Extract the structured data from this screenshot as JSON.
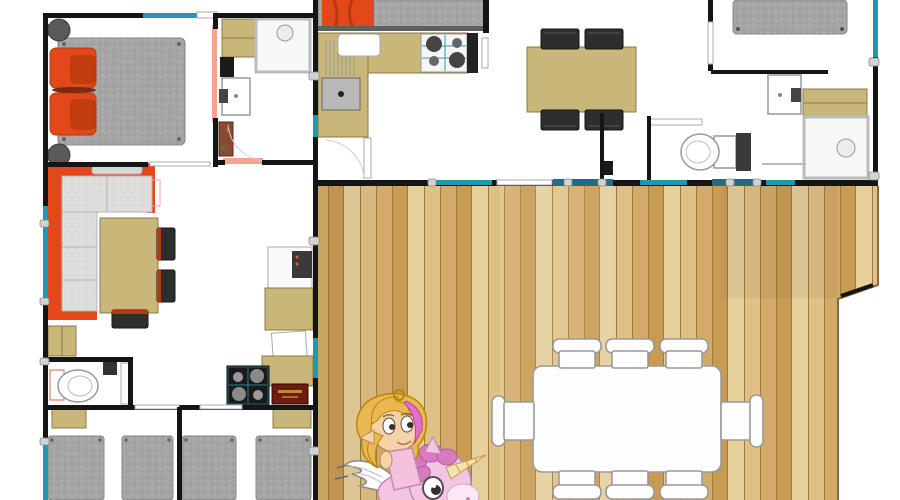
{
  "meta": {
    "type": "architectural floor plan",
    "subject": "two holiday-home units joined by a large wooden deck terrace",
    "visible_text": "none (plaque lettering illegible at source resolution)"
  },
  "left_unit": {
    "label": "left accommodation unit",
    "rooms": [
      {
        "name": "double bedroom",
        "items": [
          "double bed",
          "orange pillows",
          "round bedside stool",
          "round bedside stool",
          "salmon sliding door"
        ]
      },
      {
        "name": "shower room",
        "items": [
          "wardrobe",
          "black appliance",
          "shower cabin",
          "washbasin",
          "water heater"
        ]
      },
      {
        "name": "living room",
        "items": [
          "orange corner sofa",
          "dining table",
          "side chair",
          "side chair",
          "end chair",
          "low cabinet",
          "radiator"
        ]
      },
      {
        "name": "kitchenette",
        "items": [
          "fridge",
          "microwave",
          "worktop",
          "gas hob",
          "dark red plaque",
          "door"
        ]
      },
      {
        "name": "wc",
        "items": [
          "toilet",
          "wall cabinet",
          "door"
        ]
      },
      {
        "name": "twin bedroom left",
        "items": [
          "single bed",
          "single bed",
          "headboard shelf"
        ]
      },
      {
        "name": "twin bedroom right",
        "items": [
          "single bed",
          "single bed",
          "headboard shelf"
        ]
      }
    ]
  },
  "right_unit": {
    "label": "right accommodation unit",
    "rooms": [
      {
        "name": "bedroom top-left",
        "items": [
          "double bed with orange throw",
          "door"
        ]
      },
      {
        "name": "kitchen",
        "items": [
          "L-shaped worktop",
          "drainboard sink",
          "gas hob",
          "tall dark cabinet",
          "white counter appliance",
          "door"
        ]
      },
      {
        "name": "dining area",
        "items": [
          "dining table",
          "dark chair",
          "dark chair",
          "dark chair",
          "dark chair"
        ]
      },
      {
        "name": "bedroom top-right",
        "items": [
          "double bed",
          "teal window"
        ]
      },
      {
        "name": "bathroom",
        "items": [
          "washbasin",
          "wardrobe",
          "shower cabin",
          "shower screen"
        ]
      },
      {
        "name": "wc",
        "items": [
          "toilet",
          "black bin",
          "door"
        ]
      }
    ]
  },
  "deck": {
    "label": "wooden deck terrace",
    "shape": "rectangle with angled notch on right edge",
    "items": [
      "outdoor dining table",
      "white chair x8",
      "teal sliding glazing along unit walls"
    ]
  },
  "mascot": {
    "description": "cartoon fairy girl with blonde and pink hair riding a small pink winged unicorn",
    "position": "bottom centre, standing on the deck"
  },
  "colors": {
    "wall": "#151515",
    "floor": "#ffffff",
    "wood_a": "#d3ab68",
    "wood_b": "#e6cf9a",
    "wood_c": "#c89b52",
    "wood_d": "#dfc185",
    "wood_seam": "#9c7a40",
    "tan": "#c9b77a",
    "tan_border": "#8a7a4a",
    "orange": "#e2481a",
    "orange_dark": "#b53a0e",
    "mattress": "#a5a5a5",
    "cushion": "#dedddb",
    "chair_dark": "#2e2e2e",
    "window_teal": "#2497ae",
    "window_teal_dark": "#1a6f86",
    "salmon": "#f2a48e",
    "fixture": "#ffffff",
    "fixture_border": "#999999",
    "heater": "#8a4a32",
    "plaque": "#6e1c0e",
    "plaque_text": "#caa84a",
    "unicorn": "#f2c6e2",
    "unicorn_line": "#c288b2",
    "mane": "#d77ac2",
    "horn": "#f3e3b0",
    "hair": "#e9b94f",
    "hair_streak": "#e070c8",
    "skin": "#f6d2a8",
    "dress": "#f4c2dc"
  }
}
